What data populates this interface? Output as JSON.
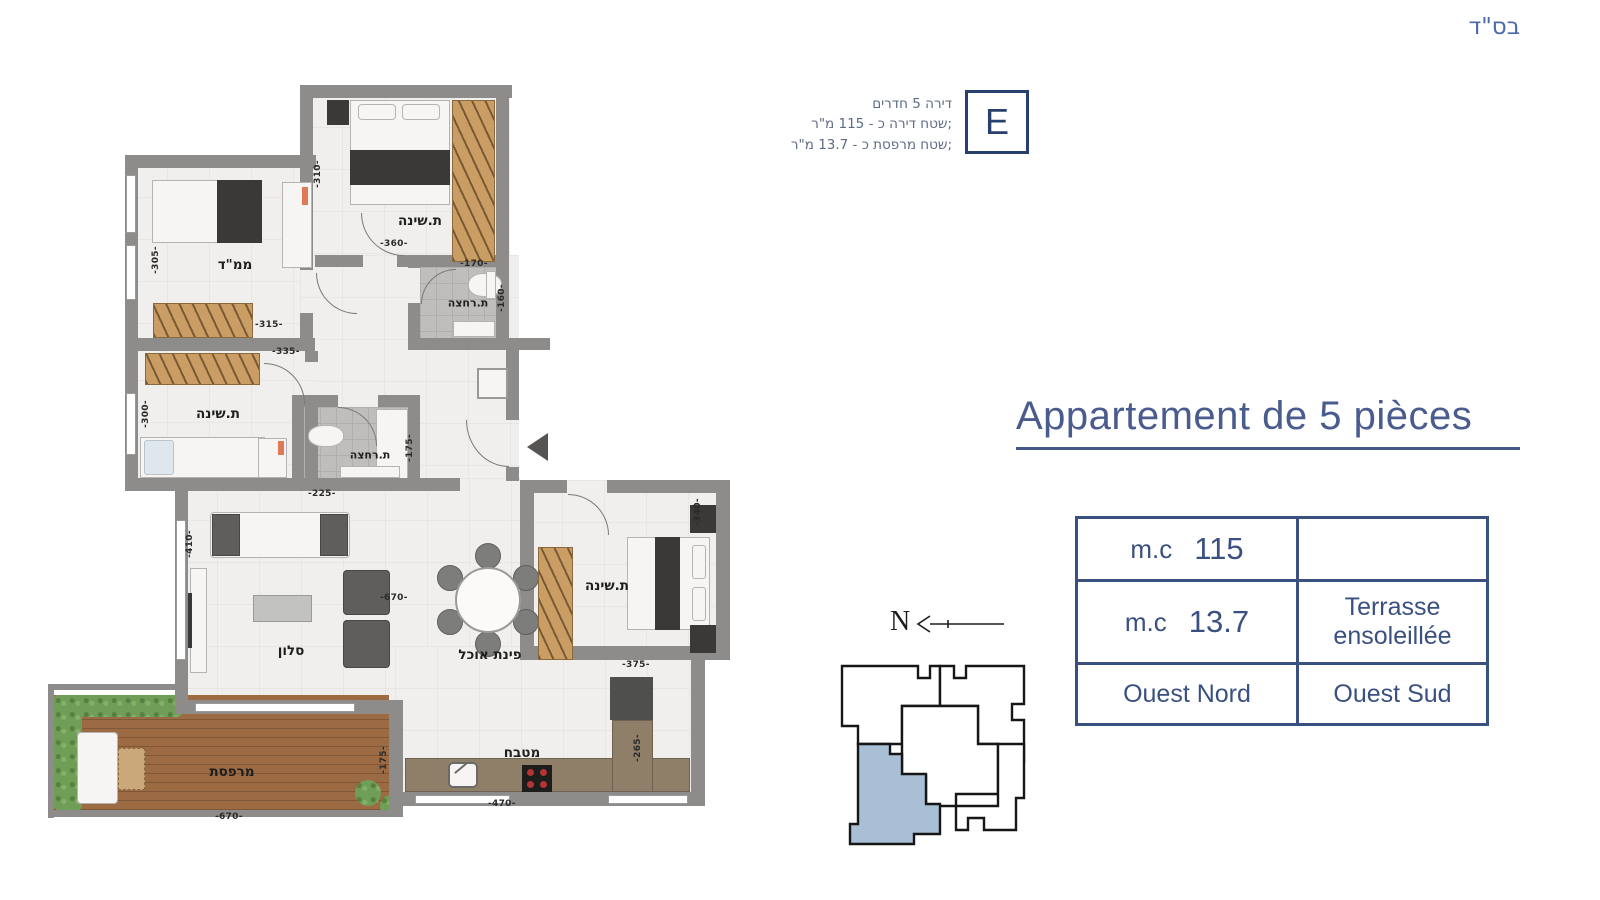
{
  "meta": {
    "bsd": "בס\"ד"
  },
  "badge": {
    "letter": "E",
    "line1": "דירה 5 חדרים",
    "line2": "שטח דירה כ - 115 מ\"ר;",
    "line3": "שטח מרפסת כ - 13.7 מ\"ר;"
  },
  "title": "Appartement de 5 pièces",
  "info_table": {
    "row1_unit": "m.c",
    "row1_value": "115",
    "row1_note": "",
    "row2_unit": "m.c",
    "row2_value": "13.7",
    "row2_note_line1": "Terrasse",
    "row2_note_line2": "ensoleillée",
    "row3_left": "Ouest Nord",
    "row3_right": "Ouest Sud"
  },
  "compass": {
    "label": "N"
  },
  "plan": {
    "rooms": {
      "mamad": "ממ\"ד",
      "bedroom_top": "ת.שינה",
      "bath_top": "ת.רחצה",
      "bedroom_left": "ת.שינה",
      "bath_mid": "ת.רחצה",
      "salon": "סלון",
      "dining": "פינת אוכל",
      "bedroom_right": "ת.שינה",
      "kitchen": "מטבח",
      "terrace": "מרפסת"
    },
    "dims": {
      "bedroom_top_w": "-360-",
      "bedroom_top_h": "-310-",
      "bath_top_w": "-170-",
      "bath_top_h": "-160-",
      "mamad_w": "-315-",
      "mamad_h": "-305-",
      "bedroom_left_w": "-335-",
      "bedroom_left_h": "-300-",
      "bath_mid_w": "-225-",
      "bath_mid_h": "-175-",
      "salon_w": "-670-",
      "salon_h": "-410-",
      "bedroom_right_w": "-375-",
      "bedroom_right_h": "-340-",
      "kitchen_w": "-470-",
      "kitchen_h": "-265-",
      "terrace_w": "-670-",
      "terrace_h": "-175-"
    }
  },
  "colors": {
    "accent": "#3a5080",
    "title": "#4a5c8e",
    "key_plan_highlight": "#a9bfd6"
  }
}
